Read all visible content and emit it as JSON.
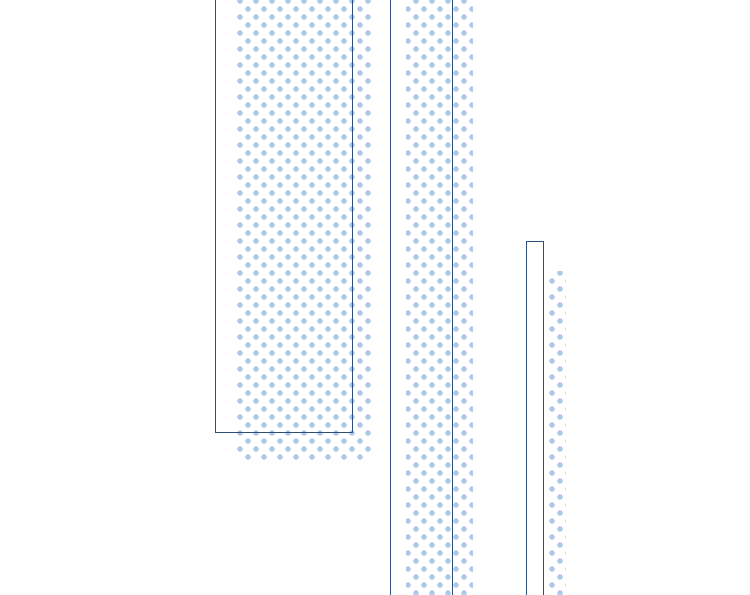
{
  "meta": {
    "description": "Abstract decorative halftone graphic: three navy-outlined vertical bars, each with a light-blue polka-dot shadow stripe offset down-right, on a plain white background. No text, labels, or interactive controls are visible.",
    "text_content": ""
  },
  "colors": {
    "background": "#ffffff",
    "outline": "#2f4f7b",
    "dot": "#aec7e8"
  },
  "pattern": {
    "dot_diameter_px": 5,
    "dot_grid_spacing_px": 16,
    "alternate_row_offset_px": 8
  },
  "elements": [
    {
      "name": "left-bar-dot-shadow",
      "shape": "polka-dot rectangle",
      "cropped_edges": "top"
    },
    {
      "name": "middle-bar-dot-shadow",
      "shape": "polka-dot stripe",
      "cropped_edges": "top and bottom"
    },
    {
      "name": "right-bar-dot-shadow",
      "shape": "polka-dot stripe",
      "cropped_edges": "bottom"
    },
    {
      "name": "left-bar-outline",
      "shape": "rectangle outline",
      "cropped_edges": "top"
    },
    {
      "name": "middle-bar-outline",
      "shape": "rectangle outline",
      "cropped_edges": "top and bottom"
    },
    {
      "name": "right-bar-outline",
      "shape": "rectangle outline",
      "cropped_edges": "bottom"
    }
  ]
}
